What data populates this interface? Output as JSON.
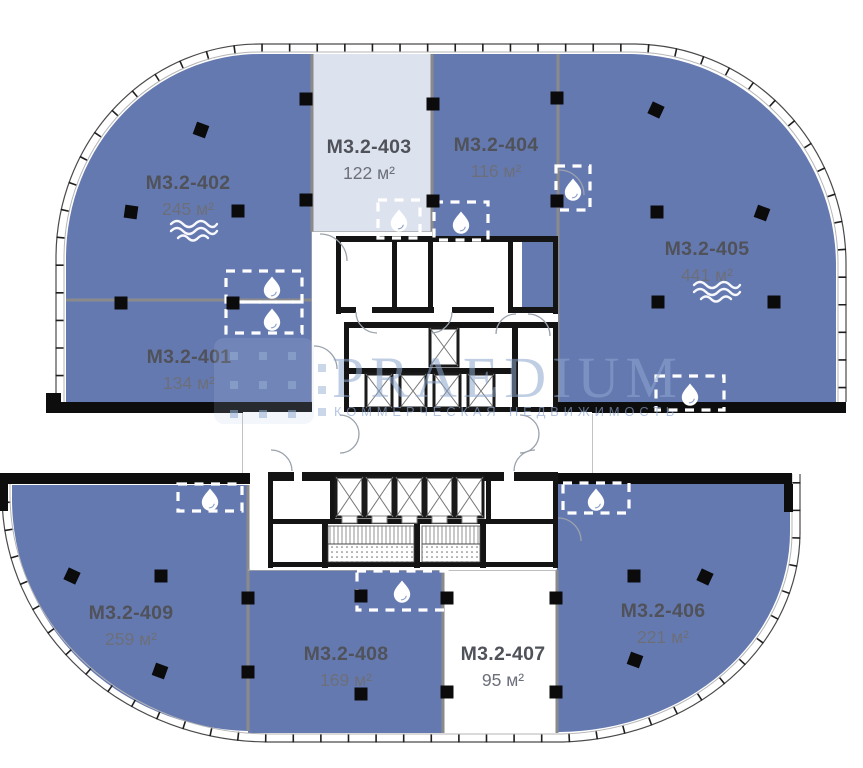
{
  "plan_title": "Floor plan level M3.2",
  "watermark": {
    "brand": "PRAEDIUM",
    "tagline": "КОММЕРЧЕСКАЯ НЕДВИЖИМОСТЬ"
  },
  "units": [
    {
      "id": "M3.2-401",
      "area": "134 м²",
      "variant": "blue",
      "features": [
        "water"
      ]
    },
    {
      "id": "M3.2-402",
      "area": "245 м²",
      "variant": "blue",
      "features": [
        "waves",
        "water"
      ]
    },
    {
      "id": "M3.2-403",
      "area": "122 м²",
      "variant": "light",
      "features": [
        "water"
      ]
    },
    {
      "id": "M3.2-404",
      "area": "116 м²",
      "variant": "blue",
      "features": [
        "water"
      ]
    },
    {
      "id": "M3.2-405",
      "area": "441 м²",
      "variant": "blue",
      "features": [
        "waves",
        "water"
      ]
    },
    {
      "id": "M3.2-406",
      "area": "221 м²",
      "variant": "blue",
      "features": [
        "water"
      ]
    },
    {
      "id": "M3.2-407",
      "area": "95 м²",
      "variant": "white",
      "features": []
    },
    {
      "id": "M3.2-408",
      "area": "169 м²",
      "variant": "blue",
      "features": [
        "water"
      ]
    },
    {
      "id": "M3.2-409",
      "area": "259 м²",
      "variant": "blue",
      "features": [
        "water"
      ]
    }
  ],
  "icons": [
    "droplet-icon",
    "waves-icon"
  ],
  "colors": {
    "unit_available": "#6579b1",
    "unit_light": "#dde3ee",
    "unit_unavailable": "#ffffff",
    "wall": "#0d0d0d",
    "divider": "#8a8a8a",
    "label": "#50525a",
    "area_label": "#6c6f7a",
    "icon": "#ffffff",
    "watermark": "#8da6cc"
  }
}
